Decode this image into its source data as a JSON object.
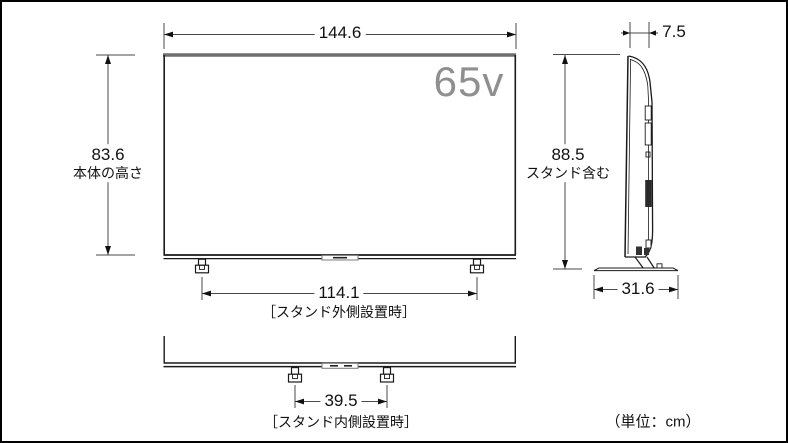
{
  "diagram": {
    "screen_size": "65v",
    "unit_note": "（単位：cm）",
    "front": {
      "width": "144.6",
      "height": "83.6",
      "height_label": "本体の高さ",
      "stand_outer_width": "114.1",
      "stand_outer_label": "［スタンド外側設置時］",
      "stand_inner_width": "39.5",
      "stand_inner_label": "［スタンド内側設置時］"
    },
    "side": {
      "depth": "7.5",
      "height_with_stand": "88.5",
      "height_with_stand_label": "スタンド含む",
      "stand_base_depth": "31.6"
    }
  }
}
